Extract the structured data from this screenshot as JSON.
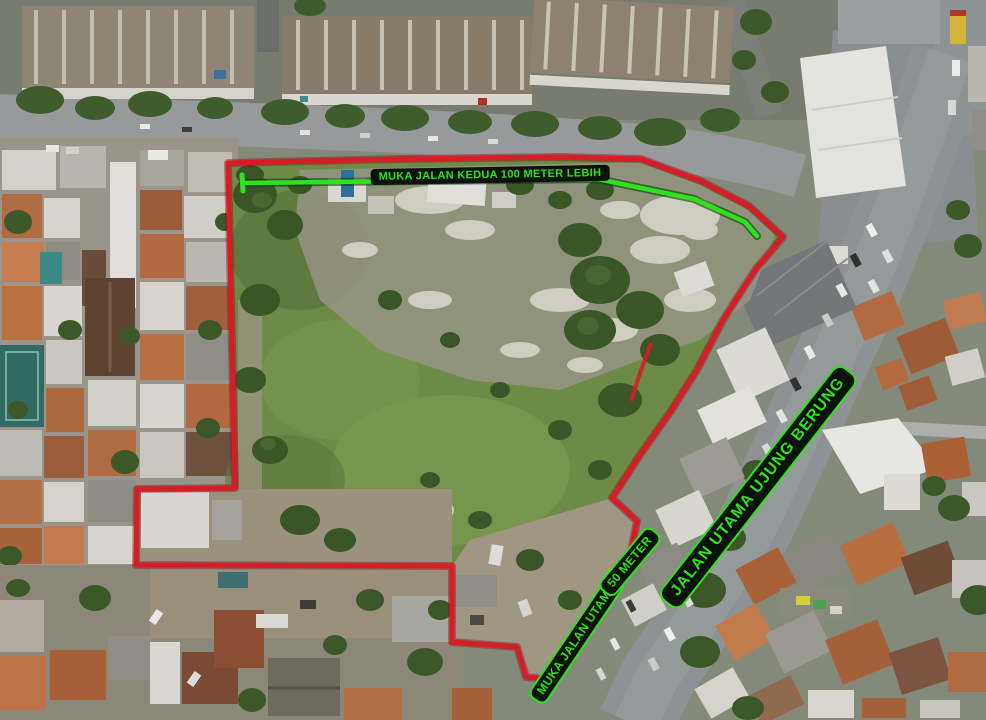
{
  "scene": {
    "type": "aerial-drone-photo",
    "subject": "Vacant land plot outlined in red among dense housing, roads and shophouses"
  },
  "annotations": {
    "top_frontage": {
      "label": "MUKA JALAN KEDUA 100 METER LEBIH"
    },
    "main_road": {
      "label": "JALAN UTAMA UJUNG BERUNG"
    },
    "bottom_frontage": {
      "label": "MUKA JALAN UTAMA"
    },
    "bottom_frontage_len": {
      "label": "50 METER"
    }
  },
  "colors": {
    "boundary_red": "#d81b24",
    "annotation_green": "#2fe31c",
    "label_bg": "#0a120a",
    "label_border_green": "#2fe31c"
  }
}
